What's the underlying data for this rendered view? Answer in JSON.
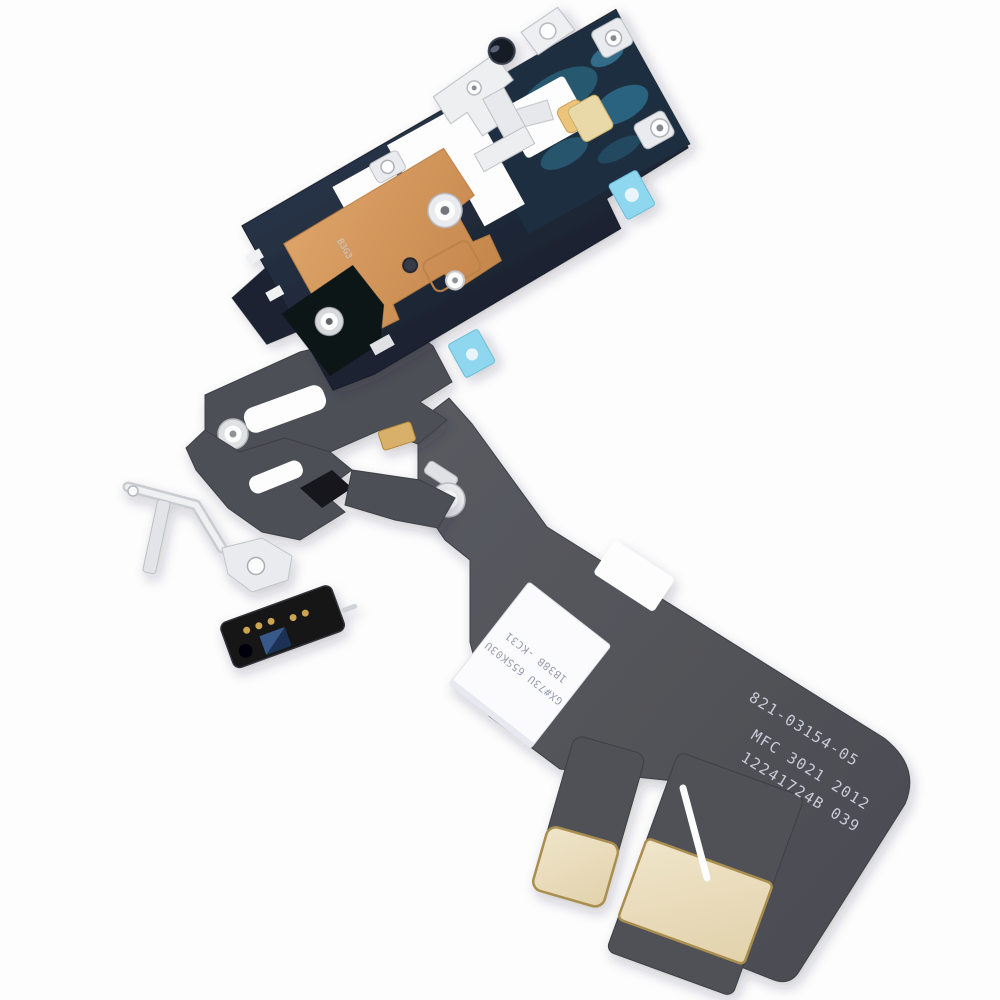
{
  "scene": {
    "type": "product-photo",
    "background_color": "#fdfdfd",
    "subject": "iPhone charging port and WiFi antenna flex cable replacement part, laid diagonally on a white studio background"
  },
  "part": {
    "printed_markings": {
      "code_top": "821-03154-05",
      "code_mid": "MFC 3021 2012",
      "code_bottom": "12241724B 039",
      "board_marking": "B3G3"
    },
    "label": {
      "line1": "GX#73U 65SK03U",
      "line2": "1B38B -KC31"
    },
    "colors": {
      "flex_dark_gray": "#4f5157",
      "pcb_navy": "#222c3a",
      "teal_patch": "#2e7290",
      "copper_flex": "#d2955c",
      "metal_bracket": "#edeff1",
      "adhesive_blue": "#8fd7ee",
      "contact_pad_cream": "#ecdfc1",
      "contact_pad_edge": "#a98e4f",
      "module_black": "#141519",
      "module_gold_dots": "#cda44f",
      "chip_blue": "#1d3054",
      "printed_text": "#c9cdd8",
      "label_white": "#fbfbfd"
    }
  }
}
